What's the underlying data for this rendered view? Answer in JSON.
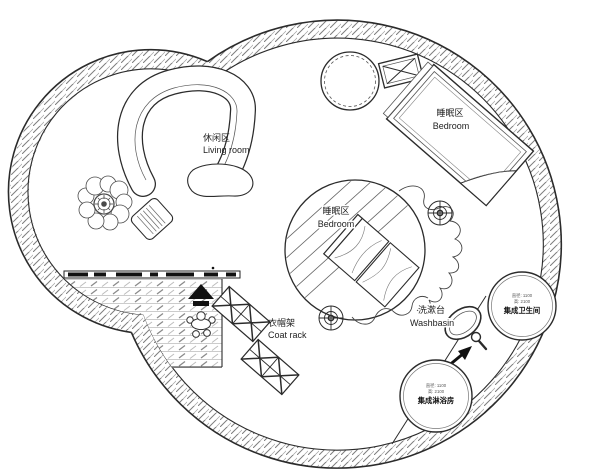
{
  "plan": {
    "labels": {
      "living_room": {
        "zh": "休闲区",
        "en": "Living room"
      },
      "bedroom_upper": {
        "zh": "睡眠区",
        "en": "Bedroom"
      },
      "bedroom_center": {
        "zh": "睡眠区",
        "en": "Bedroom"
      },
      "coat_rack": {
        "zh": "衣帽架",
        "en": "Coat rack"
      },
      "washbasin": {
        "zh": "洗漱台",
        "en": "Washbasin"
      },
      "bathroom_pod": {
        "spec_diameter": "直径: 1100",
        "spec_height": "高: 2100",
        "name": "集成卫生间"
      },
      "shower_pod": {
        "spec_diameter": "直径: 1100",
        "spec_height": "高: 2100",
        "name": "集成淋浴房"
      }
    },
    "colors": {
      "ink": "#2b2b2b",
      "hatch": "#808080",
      "paper": "#ffffff",
      "solid": "#111111"
    }
  }
}
